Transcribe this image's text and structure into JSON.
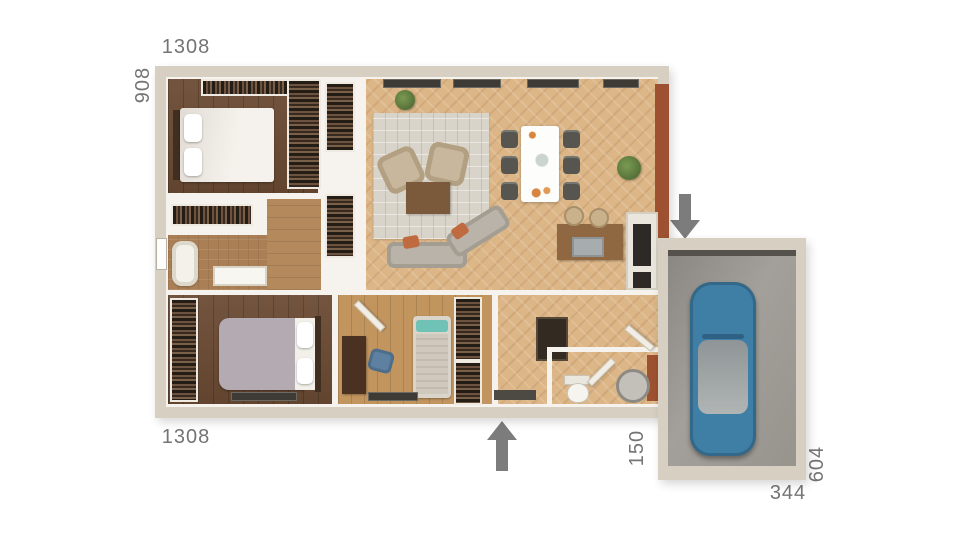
{
  "dimensions": {
    "top_width": "1308",
    "left_height": "908",
    "bottom_width": "1308",
    "entry_offset": "150",
    "garage_height": "604",
    "garage_width": "344"
  },
  "icons": {
    "garage_entry_arrow": "arrow-down",
    "main_entry_arrow": "arrow-up"
  },
  "colors": {
    "background": "#ffffff",
    "dimension_text": "#747474",
    "arrow": "#7c7c7c",
    "wall_exterior": "#d6cfc2",
    "wall_interior": "#f6f3ee",
    "floor_living": "#dcb687",
    "floor_dark_wood": "#6a4a33",
    "floor_medium_wood": "#c2955f",
    "floor_hall": "#b48a5d",
    "rug": "#d9d4ca",
    "sofa": "#b9b3a9",
    "cushion_orange": "#c06a3f",
    "accent_terracotta": "#9d5130",
    "car_body": "#3f7fa6",
    "garage_floor": "#979389"
  }
}
